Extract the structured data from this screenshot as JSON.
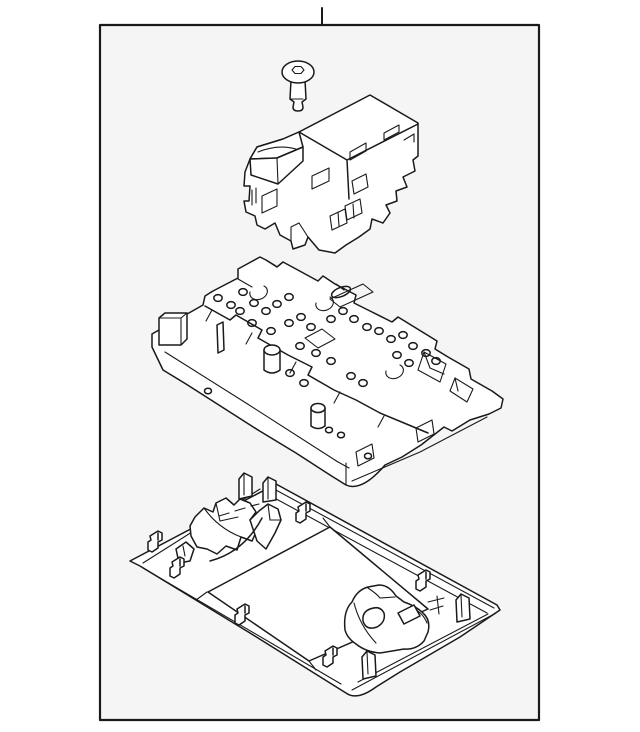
{
  "window": {
    "background": "#ffffff"
  },
  "diagram": {
    "type": "exploded-parts-line-drawing",
    "frame": {
      "fill": "#f5f5f5",
      "border_color": "#1a1a1a",
      "border_width": 2,
      "callout_tick": "top-center"
    },
    "style": {
      "part_fill": "#ffffff",
      "line_color": "#1a1a1a",
      "stroke_width": 1.5
    },
    "parts": [
      {
        "id": "screw",
        "label": "screw"
      },
      {
        "id": "switch-module",
        "label": "switch module"
      },
      {
        "id": "bracket-assembly",
        "label": "lamp bracket assembly"
      },
      {
        "id": "console-housing",
        "label": "overhead console housing"
      }
    ]
  }
}
